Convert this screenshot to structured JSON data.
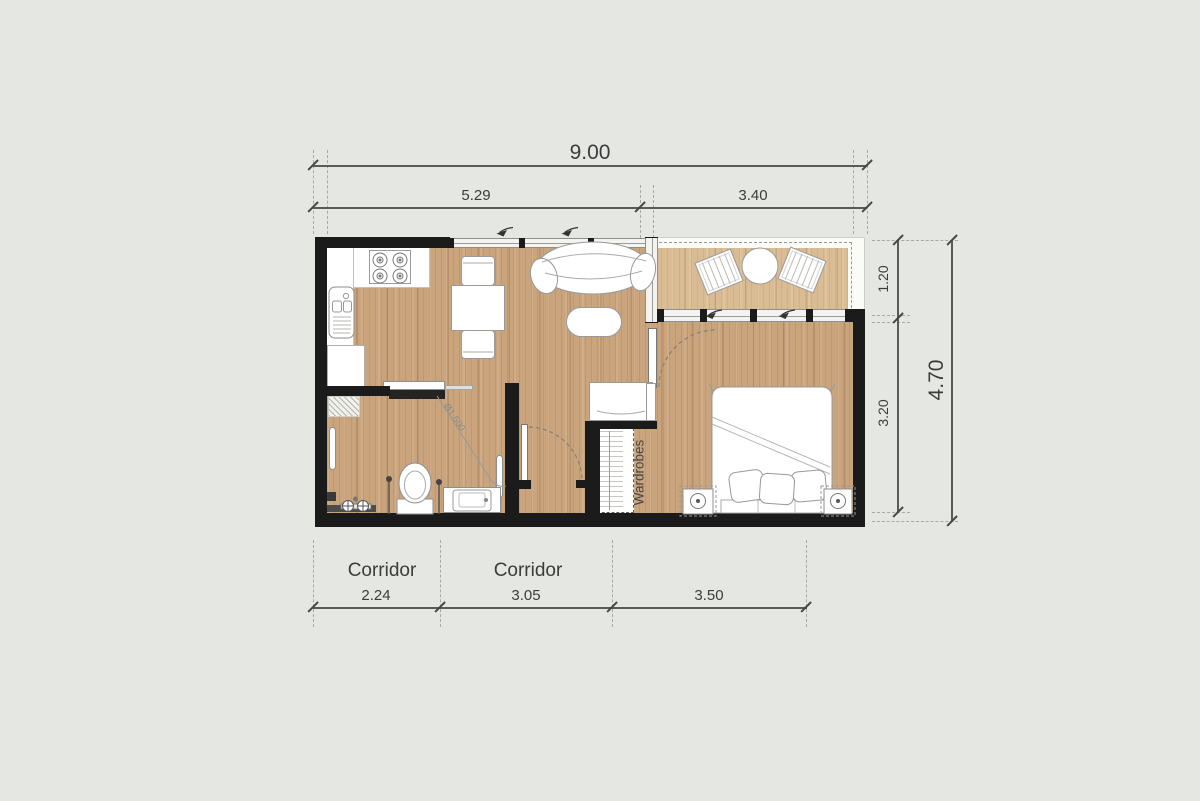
{
  "dimensions": {
    "top": {
      "overall": "9.00",
      "segments": [
        "5.29",
        "3.40"
      ]
    },
    "right": {
      "segments": [
        "1.20",
        "3.20"
      ],
      "overall": "4.70"
    },
    "bottom": {
      "segments": [
        "2.24",
        "3.05",
        "3.50"
      ]
    }
  },
  "labels": {
    "corridor_left": "Corridor",
    "corridor_middle": "Corridor",
    "wardrobes": "Wardrobes",
    "turning_circle": "Ø1.500"
  },
  "colors": {
    "background": "#e5e7e2",
    "wall": "#1b1b1b",
    "wood_floor": "#c9a47d",
    "terrace_floor": "#d9bc94",
    "fixtures": "#ffffff",
    "dimension_text": "#3c3c3c"
  }
}
